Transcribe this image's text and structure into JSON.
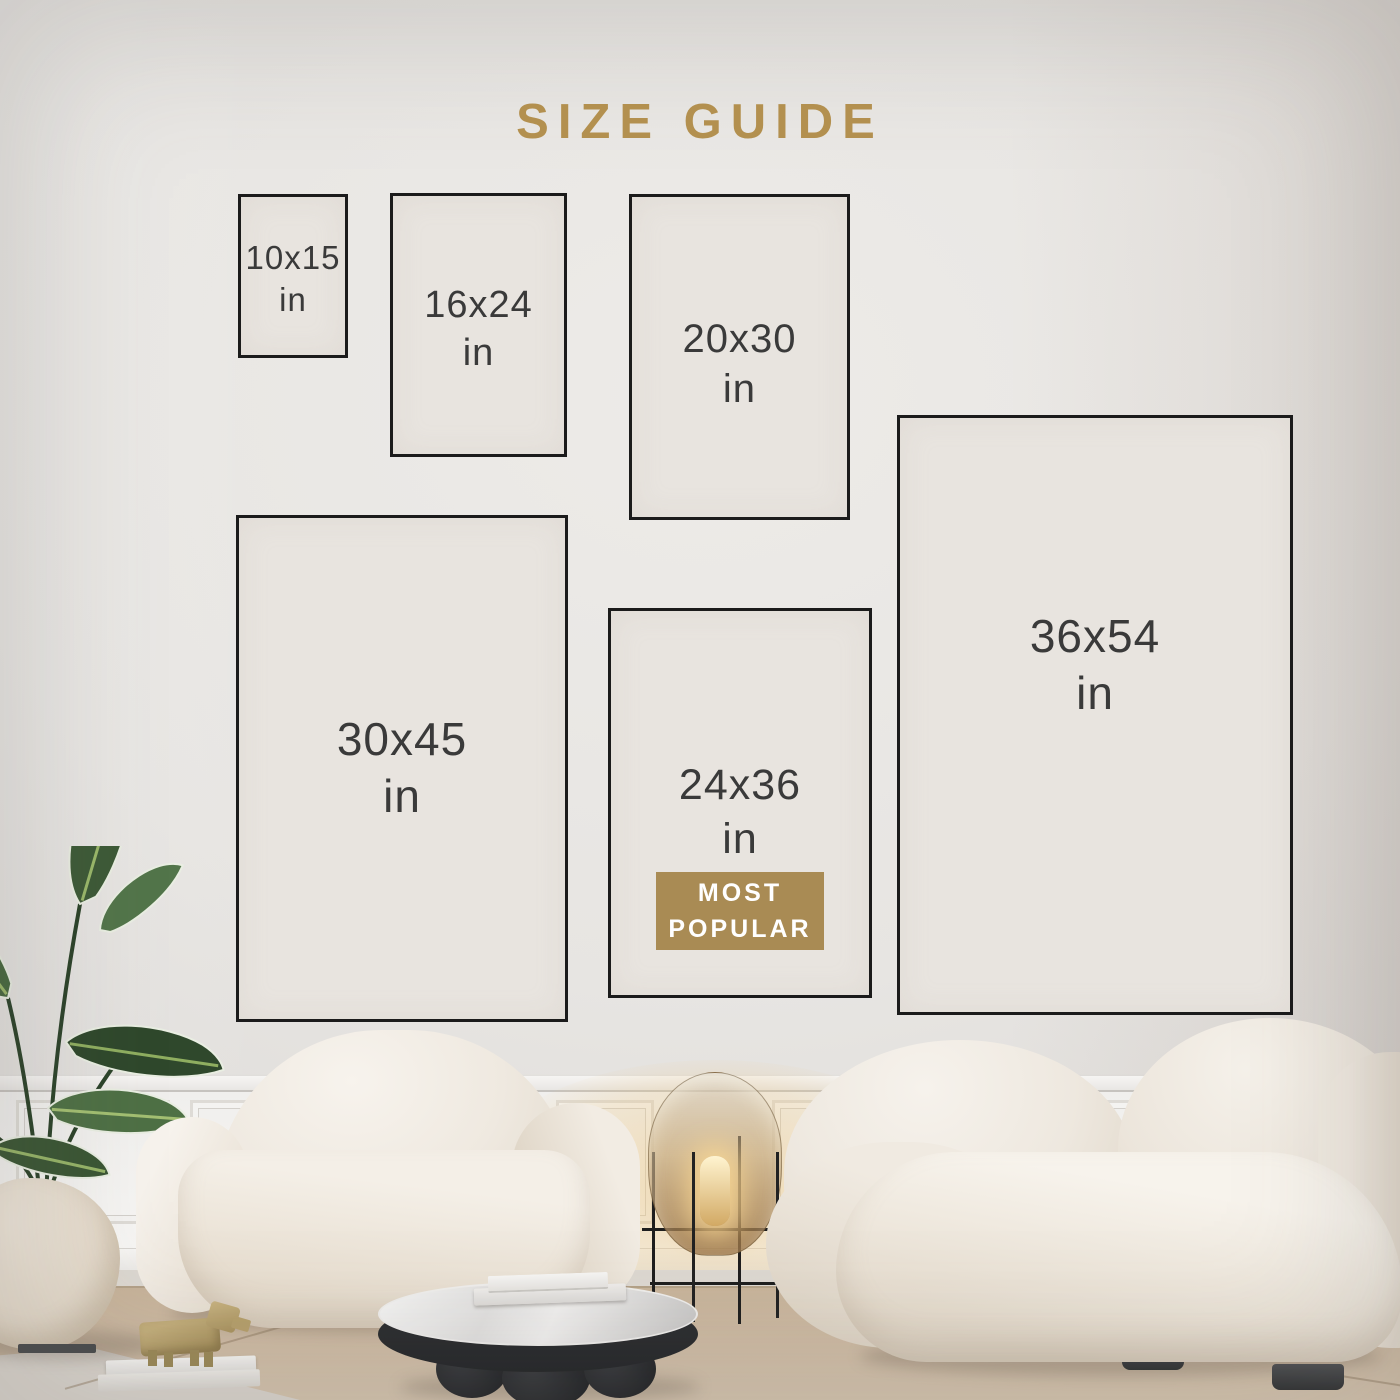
{
  "title": "SIZE GUIDE",
  "sizes": [
    {
      "dimensions": "10x15",
      "unit": "in"
    },
    {
      "dimensions": "16x24",
      "unit": "in"
    },
    {
      "dimensions": "20x30",
      "unit": "in"
    },
    {
      "dimensions": "30x45",
      "unit": "in"
    },
    {
      "dimensions": "24x36",
      "unit": "in",
      "badge_line1": "MOST",
      "badge_line2": "POPULAR"
    },
    {
      "dimensions": "36x54",
      "unit": "in"
    }
  ],
  "colors": {
    "accent_gold": "#b3904f",
    "badge_background": "#a98b54",
    "badge_text": "#ffffff",
    "box_border": "#1b1b1b",
    "box_fill": "#e8e4df",
    "label_text": "#3a3a3a"
  }
}
